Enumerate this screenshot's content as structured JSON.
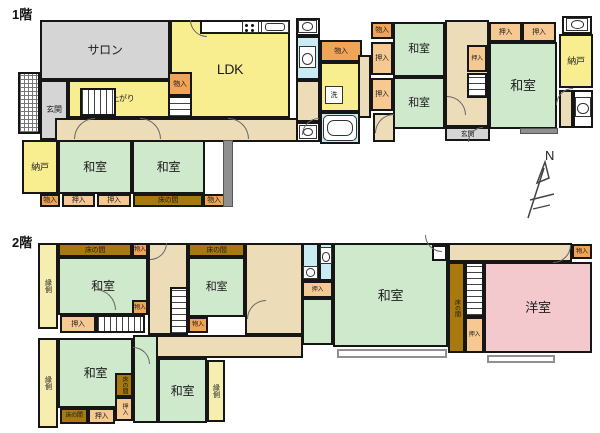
{
  "compass": {
    "label": "N"
  },
  "palette": {
    "wall": "#161616",
    "tatami_green": "#cfe9cc",
    "room_yellow": "#f9ee8f",
    "engawa_yellow": "#f6edb0",
    "corridor_tan": "#ecdcb8",
    "salon_gray": "#d5d5d5",
    "monoire_orange": "#efa458",
    "oshiire_orange": "#f6c992",
    "tokonoma_brown": "#a8790f",
    "bath_blue": "#c9ecf4",
    "youshitsu_pink": "#f4c9ce"
  },
  "floors": [
    {
      "title": "1階",
      "tx": 12,
      "ty": 8,
      "rooms": [
        {
          "n": "salon",
          "t": "gray",
          "x": 40,
          "y": 20,
          "w": 130,
          "h": 60,
          "l": "サロン",
          "fs": 12
        },
        {
          "n": "entrance-porch",
          "t": "hatch",
          "x": 18,
          "y": 72,
          "w": 22,
          "h": 62
        },
        {
          "n": "genkan-west",
          "t": "gray",
          "x": 40,
          "y": 80,
          "w": 28,
          "h": 60,
          "l": "玄関",
          "fs": 8
        },
        {
          "n": "ldk",
          "t": "yellow",
          "x": 170,
          "y": 20,
          "w": 120,
          "h": 98,
          "l": "LDK",
          "fs": 14
        },
        {
          "n": "kitchen-counter",
          "t": "white",
          "x": 200,
          "y": 20,
          "w": 90,
          "h": 14
        },
        {
          "n": "koagari",
          "t": "yellow",
          "x": 68,
          "y": 80,
          "w": 102,
          "h": 38,
          "l": "小上がり",
          "fs": 8
        },
        {
          "n": "stairs-koagari",
          "t": "stairs",
          "x": 80,
          "y": 88,
          "w": 36,
          "h": 28
        },
        {
          "n": "monoire-ldk",
          "t": "mono",
          "x": 168,
          "y": 72,
          "w": 24,
          "h": 24,
          "l": "物入",
          "fs": 7
        },
        {
          "n": "stairs-1f-west",
          "t": "stairs-v",
          "x": 168,
          "y": 96,
          "w": 24,
          "h": 22
        },
        {
          "n": "corridor-1f",
          "t": "hall",
          "x": 55,
          "y": 118,
          "w": 265,
          "h": 24
        },
        {
          "n": "nando-west",
          "t": "yellow",
          "x": 22,
          "y": 140,
          "w": 36,
          "h": 54,
          "l": "納戸",
          "fs": 9
        },
        {
          "n": "washitsu-sw1",
          "t": "wa",
          "x": 58,
          "y": 140,
          "w": 74,
          "h": 54,
          "l": "和室",
          "fs": 12
        },
        {
          "n": "washitsu-sw2",
          "t": "wa",
          "x": 132,
          "y": 140,
          "w": 73,
          "h": 54,
          "l": "和室",
          "fs": 12
        },
        {
          "n": "monoire-sw",
          "t": "mono",
          "x": 40,
          "y": 194,
          "w": 20,
          "h": 13,
          "l": "物入",
          "fs": 7
        },
        {
          "n": "oshiire-sw1",
          "t": "oshi",
          "x": 62,
          "y": 194,
          "w": 33,
          "h": 13,
          "l": "押入",
          "fs": 7
        },
        {
          "n": "oshiire-sw2",
          "t": "oshi",
          "x": 97,
          "y": 194,
          "w": 34,
          "h": 13,
          "l": "押入",
          "fs": 7
        },
        {
          "n": "tokonoma-sw",
          "t": "toko",
          "x": 133,
          "y": 194,
          "w": 70,
          "h": 13,
          "l": "床の間",
          "fs": 7
        },
        {
          "n": "monoire-sw2",
          "t": "mono",
          "x": 203,
          "y": 194,
          "w": 22,
          "h": 13,
          "l": "物入",
          "fs": 7
        },
        {
          "n": "wall-sw",
          "t": "darkwall",
          "x": 223,
          "y": 140,
          "w": 10,
          "h": 67
        },
        {
          "n": "basin-nook-top",
          "t": "white",
          "x": 296,
          "y": 18,
          "w": 24,
          "h": 18
        },
        {
          "n": "toilet-room-mid",
          "t": "bath",
          "x": 296,
          "y": 36,
          "w": 24,
          "h": 44
        },
        {
          "n": "hall-sanitary",
          "t": "hall",
          "x": 296,
          "y": 80,
          "w": 24,
          "h": 42
        },
        {
          "n": "basin-nook-bottom",
          "t": "white",
          "x": 296,
          "y": 122,
          "w": 24,
          "h": 20
        },
        {
          "n": "monoire-mid",
          "t": "mono",
          "x": 320,
          "y": 40,
          "w": 42,
          "h": 22,
          "l": "物入",
          "fs": 7
        },
        {
          "n": "senmenjo",
          "t": "yellow",
          "x": 320,
          "y": 62,
          "w": 42,
          "h": 50
        },
        {
          "n": "bathroom",
          "t": "bath",
          "x": 320,
          "y": 112,
          "w": 40,
          "h": 32
        },
        {
          "n": "hall-mid-v",
          "t": "hall",
          "x": 358,
          "y": 55,
          "w": 13,
          "h": 63
        },
        {
          "n": "hall-mid-pocket",
          "t": "hall",
          "x": 373,
          "y": 113,
          "w": 22,
          "h": 29
        },
        {
          "n": "monoire-col",
          "t": "mono",
          "x": 371,
          "y": 22,
          "w": 22,
          "h": 17,
          "l": "物入",
          "fs": 7
        },
        {
          "n": "oshiire-col1",
          "t": "oshi",
          "x": 371,
          "y": 42,
          "w": 22,
          "h": 33,
          "l": "押入",
          "fs": 7
        },
        {
          "n": "oshiire-col2",
          "t": "oshi",
          "x": 371,
          "y": 78,
          "w": 22,
          "h": 33,
          "l": "押入",
          "fs": 7
        },
        {
          "n": "washitsu-mid1",
          "t": "wa",
          "x": 393,
          "y": 22,
          "w": 52,
          "h": 55,
          "l": "和室",
          "fs": 11
        },
        {
          "n": "washitsu-mid2",
          "t": "wa",
          "x": 393,
          "y": 77,
          "w": 52,
          "h": 52,
          "l": "和室",
          "fs": 11
        },
        {
          "n": "hall-east",
          "t": "hall",
          "x": 445,
          "y": 20,
          "w": 44,
          "h": 107
        },
        {
          "n": "oshiire-east-s",
          "t": "oshi",
          "x": 467,
          "y": 45,
          "w": 20,
          "h": 27,
          "l": "押入",
          "fs": 6
        },
        {
          "n": "stairs-1f-east",
          "t": "stairs-v",
          "x": 467,
          "y": 73,
          "w": 20,
          "h": 25
        },
        {
          "n": "oshiire-ne1",
          "t": "oshi",
          "x": 489,
          "y": 22,
          "w": 33,
          "h": 20,
          "l": "押入",
          "fs": 7
        },
        {
          "n": "oshiire-ne2",
          "t": "oshi",
          "x": 522,
          "y": 22,
          "w": 34,
          "h": 20,
          "l": "押入",
          "fs": 7
        },
        {
          "n": "washitsu-east",
          "t": "wa",
          "x": 489,
          "y": 42,
          "w": 68,
          "h": 87,
          "l": "和室",
          "fs": 13
        },
        {
          "n": "basin-nook-ne",
          "t": "white",
          "x": 562,
          "y": 16,
          "w": 30,
          "h": 18
        },
        {
          "n": "nando-east",
          "t": "yellow",
          "x": 559,
          "y": 34,
          "w": 34,
          "h": 54,
          "l": "納戸",
          "fs": 9
        },
        {
          "n": "hall-ne",
          "t": "hall",
          "x": 559,
          "y": 90,
          "w": 14,
          "h": 38
        },
        {
          "n": "toilet-room-east",
          "t": "white",
          "x": 573,
          "y": 90,
          "w": 20,
          "h": 38
        },
        {
          "n": "genkan-east",
          "t": "gray",
          "x": 445,
          "y": 127,
          "w": 45,
          "h": 14,
          "l": "玄関",
          "fs": 7
        },
        {
          "n": "step-east",
          "t": "darkwall",
          "x": 520,
          "y": 128,
          "w": 38,
          "h": 6
        }
      ],
      "icons": [
        {
          "k": "stove",
          "x": 242,
          "y": 21,
          "w": 17,
          "h": 12
        },
        {
          "k": "sink",
          "x": 261,
          "y": 21,
          "w": 28,
          "h": 12
        },
        {
          "k": "basin",
          "x": 298,
          "y": 20,
          "w": 19,
          "h": 13
        },
        {
          "k": "toilet",
          "x": 299,
          "y": 46,
          "w": 17,
          "h": 22
        },
        {
          "k": "wash",
          "x": 325,
          "y": 86,
          "w": 18,
          "h": 18,
          "l": "洗"
        },
        {
          "k": "tub",
          "x": 323,
          "y": 115,
          "w": 34,
          "h": 26
        },
        {
          "k": "basin",
          "x": 299,
          "y": 125,
          "w": 18,
          "h": 14
        },
        {
          "k": "basin",
          "x": 566,
          "y": 18,
          "w": 22,
          "h": 13
        },
        {
          "k": "toilet",
          "x": 575,
          "y": 97,
          "w": 16,
          "h": 20
        }
      ],
      "arcs": [
        {
          "x": 74,
          "y": 118,
          "s": 20,
          "r": "tl"
        },
        {
          "x": 190,
          "y": 20,
          "s": 16,
          "r": "bl"
        },
        {
          "x": 140,
          "y": 118,
          "s": 20,
          "r": "tr"
        },
        {
          "x": 228,
          "y": 118,
          "s": 20,
          "r": "tr"
        },
        {
          "x": 302,
          "y": 118,
          "s": 16,
          "r": "tl"
        },
        {
          "x": 375,
          "y": 114,
          "s": 18,
          "r": "tl"
        },
        {
          "x": 447,
          "y": 96,
          "s": 18,
          "r": "tr"
        },
        {
          "x": 468,
          "y": 127,
          "s": 14,
          "r": "tl"
        },
        {
          "x": 556,
          "y": 88,
          "s": 16,
          "r": "tl"
        }
      ]
    },
    {
      "title": "2階",
      "tx": 12,
      "ty": 236,
      "rooms": [
        {
          "n": "engawa-nw",
          "t": "engawa",
          "x": 38,
          "y": 243,
          "w": 20,
          "h": 86,
          "l": "縁側",
          "fs": 7,
          "v": true
        },
        {
          "n": "tokonoma-nw",
          "t": "toko",
          "x": 58,
          "y": 243,
          "w": 74,
          "h": 14,
          "l": "床の間",
          "fs": 7
        },
        {
          "n": "monoire-nw1",
          "t": "mono",
          "x": 132,
          "y": 243,
          "w": 16,
          "h": 14,
          "l": "物入",
          "fs": 6
        },
        {
          "n": "washitsu-nw",
          "t": "wa",
          "x": 58,
          "y": 257,
          "w": 90,
          "h": 58,
          "l": "和室",
          "fs": 12
        },
        {
          "n": "monoire-nw2",
          "t": "mono",
          "x": 132,
          "y": 300,
          "w": 16,
          "h": 15,
          "l": "物入",
          "fs": 6
        },
        {
          "n": "oshiire-nw",
          "t": "oshi",
          "x": 60,
          "y": 315,
          "w": 36,
          "h": 18,
          "l": "押入",
          "fs": 7
        },
        {
          "n": "stairs-2f-west",
          "t": "stairs",
          "x": 96,
          "y": 315,
          "w": 49,
          "h": 18
        },
        {
          "n": "hall-2f-west",
          "t": "hall",
          "x": 148,
          "y": 243,
          "w": 40,
          "h": 92
        },
        {
          "n": "tokonoma-n2",
          "t": "toko",
          "x": 188,
          "y": 243,
          "w": 57,
          "h": 14,
          "l": "床の間",
          "fs": 7
        },
        {
          "n": "washitsu-n2",
          "t": "wa",
          "x": 188,
          "y": 257,
          "w": 57,
          "h": 60,
          "l": "和室",
          "fs": 11
        },
        {
          "n": "stairs-2f-mid",
          "t": "stairs-v",
          "x": 170,
          "y": 287,
          "w": 18,
          "h": 48
        },
        {
          "n": "monoire-mid2f",
          "t": "mono",
          "x": 188,
          "y": 317,
          "w": 20,
          "h": 16,
          "l": "物入",
          "fs": 6
        },
        {
          "n": "corridor-2f",
          "t": "hall",
          "x": 148,
          "y": 335,
          "w": 155,
          "h": 23
        },
        {
          "n": "hall-2f-center",
          "t": "hall",
          "x": 245,
          "y": 243,
          "w": 58,
          "h": 92
        },
        {
          "n": "basin-room-2f",
          "t": "bath",
          "x": 302,
          "y": 243,
          "w": 17,
          "h": 38
        },
        {
          "n": "toilet-room-2f",
          "t": "bath",
          "x": 319,
          "y": 243,
          "w": 14,
          "h": 38
        },
        {
          "n": "oshiire-c2f",
          "t": "oshi",
          "x": 302,
          "y": 281,
          "w": 31,
          "h": 17,
          "l": "押入",
          "fs": 6
        },
        {
          "n": "washitsu-annex",
          "t": "wa",
          "x": 302,
          "y": 298,
          "w": 31,
          "h": 47
        },
        {
          "n": "washitsu-big",
          "t": "wa",
          "x": 333,
          "y": 243,
          "w": 115,
          "h": 104,
          "l": "和室",
          "fs": 13
        },
        {
          "n": "balcony-center",
          "t": "balcony",
          "x": 337,
          "y": 349,
          "w": 110,
          "h": 9
        },
        {
          "n": "landing-east",
          "t": "hall",
          "x": 448,
          "y": 243,
          "w": 124,
          "h": 19
        },
        {
          "n": "monoire-ne2f",
          "t": "mono",
          "x": 572,
          "y": 244,
          "w": 20,
          "h": 15,
          "l": "物入",
          "fs": 6
        },
        {
          "n": "double-door",
          "t": "white",
          "x": 432,
          "y": 245,
          "w": 15,
          "h": 16
        },
        {
          "n": "tokonoma-east",
          "t": "toko",
          "x": 448,
          "y": 262,
          "w": 17,
          "h": 91,
          "l": "床の間",
          "fs": 6,
          "v": true
        },
        {
          "n": "stairs-2f-east",
          "t": "stairs-v",
          "x": 465,
          "y": 262,
          "w": 19,
          "h": 55
        },
        {
          "n": "oshiire-east2f",
          "t": "oshi",
          "x": 465,
          "y": 317,
          "w": 19,
          "h": 36,
          "l": "押入",
          "fs": 6
        },
        {
          "n": "youshitsu",
          "t": "pink",
          "x": 484,
          "y": 262,
          "w": 108,
          "h": 91,
          "l": "洋室",
          "fs": 13
        },
        {
          "n": "balcony-east",
          "t": "balcony",
          "x": 487,
          "y": 355,
          "w": 68,
          "h": 8
        },
        {
          "n": "engawa-sw",
          "t": "engawa",
          "x": 38,
          "y": 338,
          "w": 20,
          "h": 90,
          "l": "縁側",
          "fs": 7,
          "v": true
        },
        {
          "n": "washitsu-sw2f",
          "t": "wa",
          "x": 58,
          "y": 338,
          "w": 75,
          "h": 70,
          "l": "和室",
          "fs": 12
        },
        {
          "n": "tokonoma-c1",
          "t": "toko",
          "x": 115,
          "y": 373,
          "w": 18,
          "h": 24,
          "l": "床の間",
          "fs": 6,
          "v": true
        },
        {
          "n": "oshiire-c1",
          "t": "oshi",
          "x": 115,
          "y": 397,
          "w": 18,
          "h": 24,
          "l": "押入",
          "fs": 6,
          "v": true
        },
        {
          "n": "tokonoma-s",
          "t": "toko",
          "x": 60,
          "y": 408,
          "w": 28,
          "h": 16,
          "l": "床の間",
          "fs": 6
        },
        {
          "n": "oshiire-s",
          "t": "oshi",
          "x": 88,
          "y": 408,
          "w": 27,
          "h": 16,
          "l": "押入",
          "fs": 7
        },
        {
          "n": "washitsu-se-a",
          "t": "wa",
          "x": 133,
          "y": 335,
          "w": 25,
          "h": 88
        },
        {
          "n": "washitsu-se",
          "t": "wa",
          "x": 158,
          "y": 358,
          "w": 49,
          "h": 65,
          "l": "和室",
          "fs": 12
        },
        {
          "n": "engawa-se",
          "t": "engawa",
          "x": 207,
          "y": 360,
          "w": 18,
          "h": 62,
          "l": "縁側",
          "fs": 7,
          "v": true
        }
      ],
      "icons": [
        {
          "k": "basin",
          "x": 303,
          "y": 266,
          "w": 15,
          "h": 13
        },
        {
          "k": "toilet",
          "x": 320,
          "y": 247,
          "w": 12,
          "h": 17
        }
      ],
      "arcs": [
        {
          "x": 95,
          "y": 289,
          "s": 20,
          "r": "tr"
        },
        {
          "x": 150,
          "y": 243,
          "s": 16,
          "r": "br"
        },
        {
          "x": 247,
          "y": 300,
          "s": 18,
          "r": "tl"
        },
        {
          "x": 425,
          "y": 235,
          "s": 16,
          "r": "bl"
        },
        {
          "x": 553,
          "y": 245,
          "s": 17,
          "r": "br"
        },
        {
          "x": 133,
          "y": 347,
          "s": 16,
          "r": "tr"
        }
      ]
    }
  ]
}
